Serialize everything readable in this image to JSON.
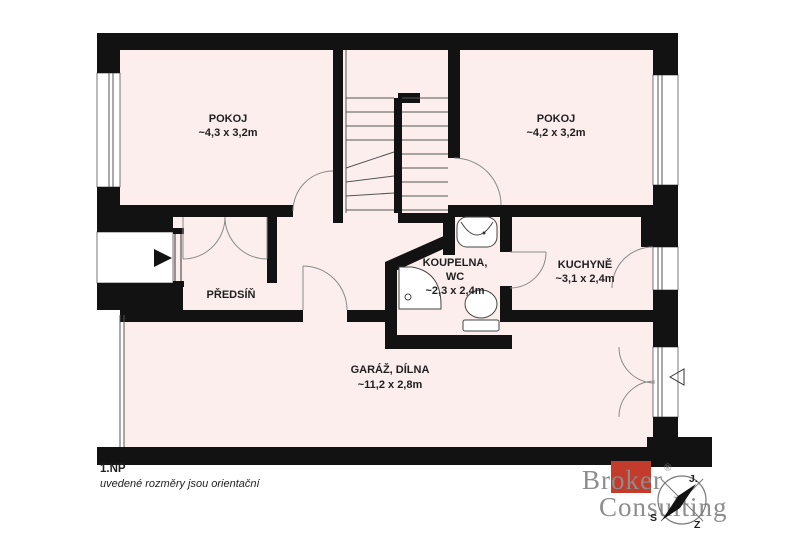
{
  "colors": {
    "wall": "#121212",
    "floor": "#fbeeec",
    "line": "#555555",
    "arc": "#8a8a8a",
    "fixture": "#444444",
    "label": "#1f1f1f",
    "white": "#ffffff",
    "logo_gray": "#8d8d8d",
    "logo_red": "#c23b2b",
    "compass_stroke": "#777777"
  },
  "floor_plan": {
    "floor_label": "1.NP",
    "disclaimer": "uvedené rozměry jsou orientační",
    "rooms": [
      {
        "id": "pokoj-left",
        "name": "POKOJ",
        "dims": "~4,3 x 3,2m"
      },
      {
        "id": "pokoj-right",
        "name": "POKOJ",
        "dims": "~4,2 x 3,2m"
      },
      {
        "id": "predsin",
        "name": "PŘEDSÍŇ",
        "dims": ""
      },
      {
        "id": "koupelna-wc",
        "name": "KOUPELNA,",
        "name2": "WC",
        "dims": "~2,3 x 2,4m"
      },
      {
        "id": "kuchyne",
        "name": "KUCHYNĚ",
        "dims": "~3,1 x 2,4m"
      },
      {
        "id": "garaz-dilna",
        "name": "GARÁŽ, DÍLNA",
        "dims": "~11,2 x 2,8m"
      }
    ]
  },
  "logo": {
    "brand_line1": "Broker",
    "brand_line2": "Consulting",
    "registered_mark": "®"
  },
  "compass": {
    "s": "S",
    "j": "J.",
    "z": "Z"
  }
}
